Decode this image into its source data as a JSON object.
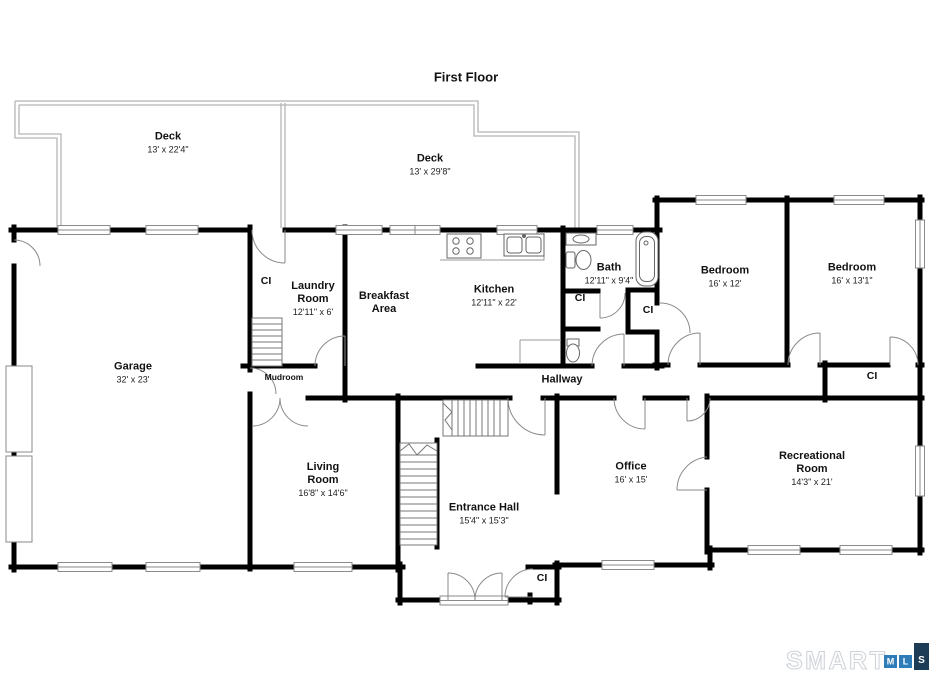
{
  "title": "First Floor",
  "closet_label": "CI",
  "areas": {
    "deck_left": {
      "name": "Deck",
      "dims": "13' x 22'4\""
    },
    "deck_right": {
      "name": "Deck",
      "dims": "13' x 29'8\""
    },
    "garage": {
      "name": "Garage",
      "dims": "32' x 23'"
    },
    "laundry": {
      "name": "Laundry Room",
      "dims": "12'11\" x 6'"
    },
    "mudroom": {
      "name": "Mudroom"
    },
    "breakfast": {
      "name": "Breakfast Area"
    },
    "kitchen": {
      "name": "Kitchen",
      "dims": "12'11\" x 22'"
    },
    "bath": {
      "name": "Bath",
      "dims": "12'11\" x 9'4\""
    },
    "bedroom_left": {
      "name": "Bedroom",
      "dims": "16' x 12'"
    },
    "bedroom_right": {
      "name": "Bedroom",
      "dims": "16' x 13'1\""
    },
    "hallway": {
      "name": "Hallway"
    },
    "living": {
      "name": "Living Room",
      "dims": "16'8\" x 14'6\""
    },
    "entrance": {
      "name": "Entrance Hall",
      "dims": "15'4\" x 15'3\""
    },
    "office": {
      "name": "Office",
      "dims": "16' x 15'"
    },
    "recreational": {
      "name": "Recreational Room",
      "dims": "14'3\" x 21'"
    }
  },
  "logo": {
    "brand": "SMART",
    "mls": [
      "M",
      "L",
      "S"
    ]
  },
  "colors": {
    "wall": "#000000",
    "deck_outline": "#b5b5b5",
    "door_line": "#8a8a8a",
    "logo_outline": "#cfd4da",
    "logo_blue": "#2e7cb8",
    "logo_navy": "#1d3c55"
  }
}
